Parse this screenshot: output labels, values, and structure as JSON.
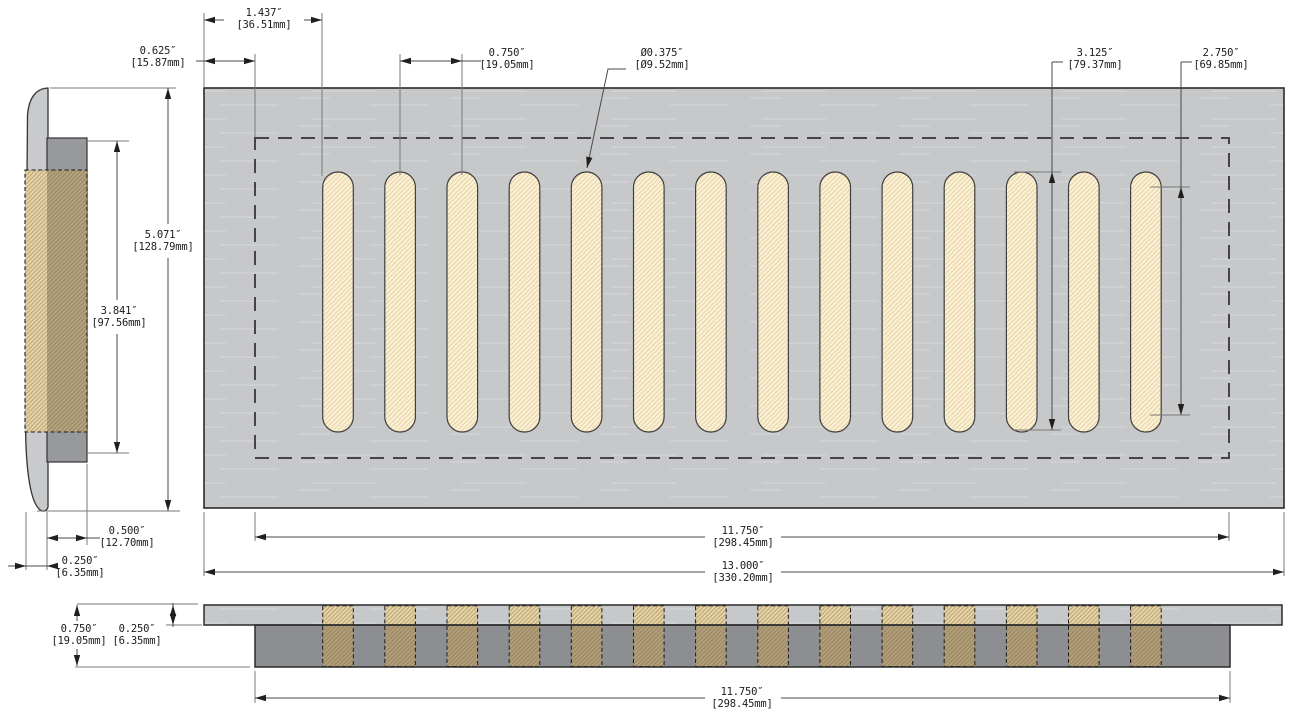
{
  "drawing": {
    "kind": "technical-dimension-drawing",
    "subject": "slotted vent faceplate with drop-in sleeve, three orthographic views"
  },
  "dimensions": {
    "slot_offset": {
      "inches": "1.437″",
      "mm": "[36.51mm]"
    },
    "opening_inset": {
      "inches": "0.625″",
      "mm": "[15.87mm]"
    },
    "slot_pitch": {
      "inches": "0.750″",
      "mm": "[19.05mm]"
    },
    "slot_width": {
      "inches": "Ø0.375″",
      "mm": "[Ø9.52mm]"
    },
    "slot_length": {
      "inches": "3.125″",
      "mm": "[79.37mm]"
    },
    "slot_straight_length": {
      "inches": "2.750″",
      "mm": "[69.85mm]"
    },
    "plate_height": {
      "inches": "5.071″",
      "mm": "[128.79mm]"
    },
    "sleeve_height": {
      "inches": "3.841″",
      "mm": "[97.56mm]"
    },
    "sleeve_depth": {
      "inches": "0.500″",
      "mm": "[12.70mm]"
    },
    "face_thickness": {
      "inches": "0.250″",
      "mm": "[6.35mm]"
    },
    "opening_width": {
      "inches": "11.750″",
      "mm": "[298.45mm]"
    },
    "plate_width": {
      "inches": "13.000″",
      "mm": "[330.20mm]"
    },
    "overall_depth": {
      "inches": "0.750″",
      "mm": "[19.05mm]"
    },
    "plate_thickness": {
      "inches": "0.250″",
      "mm": "[6.35mm]"
    },
    "opening_width_bottom": {
      "inches": "11.750″",
      "mm": "[298.45mm]"
    }
  },
  "slots": {
    "count": 14
  },
  "colors": {
    "plate_gray": "#c7c8ca",
    "plate_streak": "#d8d9db",
    "sleeve_gray": "#8d8e91",
    "side_sleeve_gray": "#98999c",
    "slot_fill": "#f9f2da",
    "slot_hatch": "#eccf9b",
    "hidden_tan_light": "#e6d5ab",
    "hidden_tan_dark": "#b2a383",
    "outline": "#2b2b2b",
    "dim_line": "#4a4a4a",
    "ext_line": "#7a7a7a",
    "text": "#1b1b1b"
  }
}
